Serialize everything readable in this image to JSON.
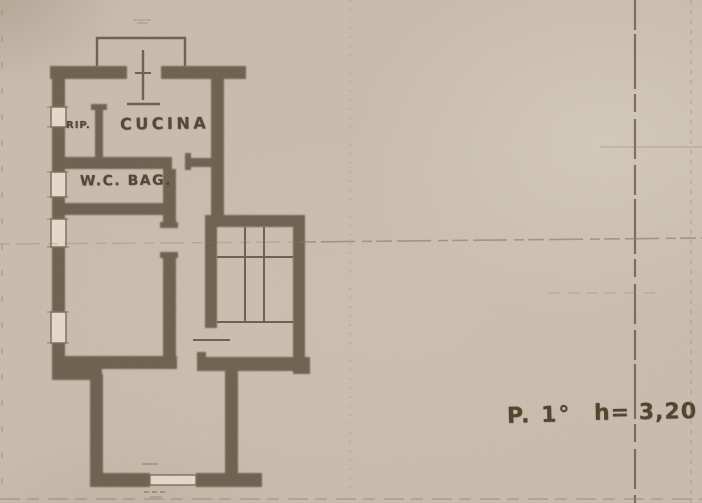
{
  "scan": {
    "kind": "architectural floor plan (scanned blueprint)",
    "rooms": {
      "rip_label": "RIP.",
      "cucina_label": "CUCINA",
      "wc_label": "W.C. BAG."
    },
    "note": {
      "floor_label": "P. 1°",
      "height_label": "h= 3,20"
    },
    "colors": {
      "paper": "#c9beb0",
      "wall_ink": "#6b5d4c",
      "text_ink": "#564836",
      "fold_line": "#63523f"
    }
  }
}
